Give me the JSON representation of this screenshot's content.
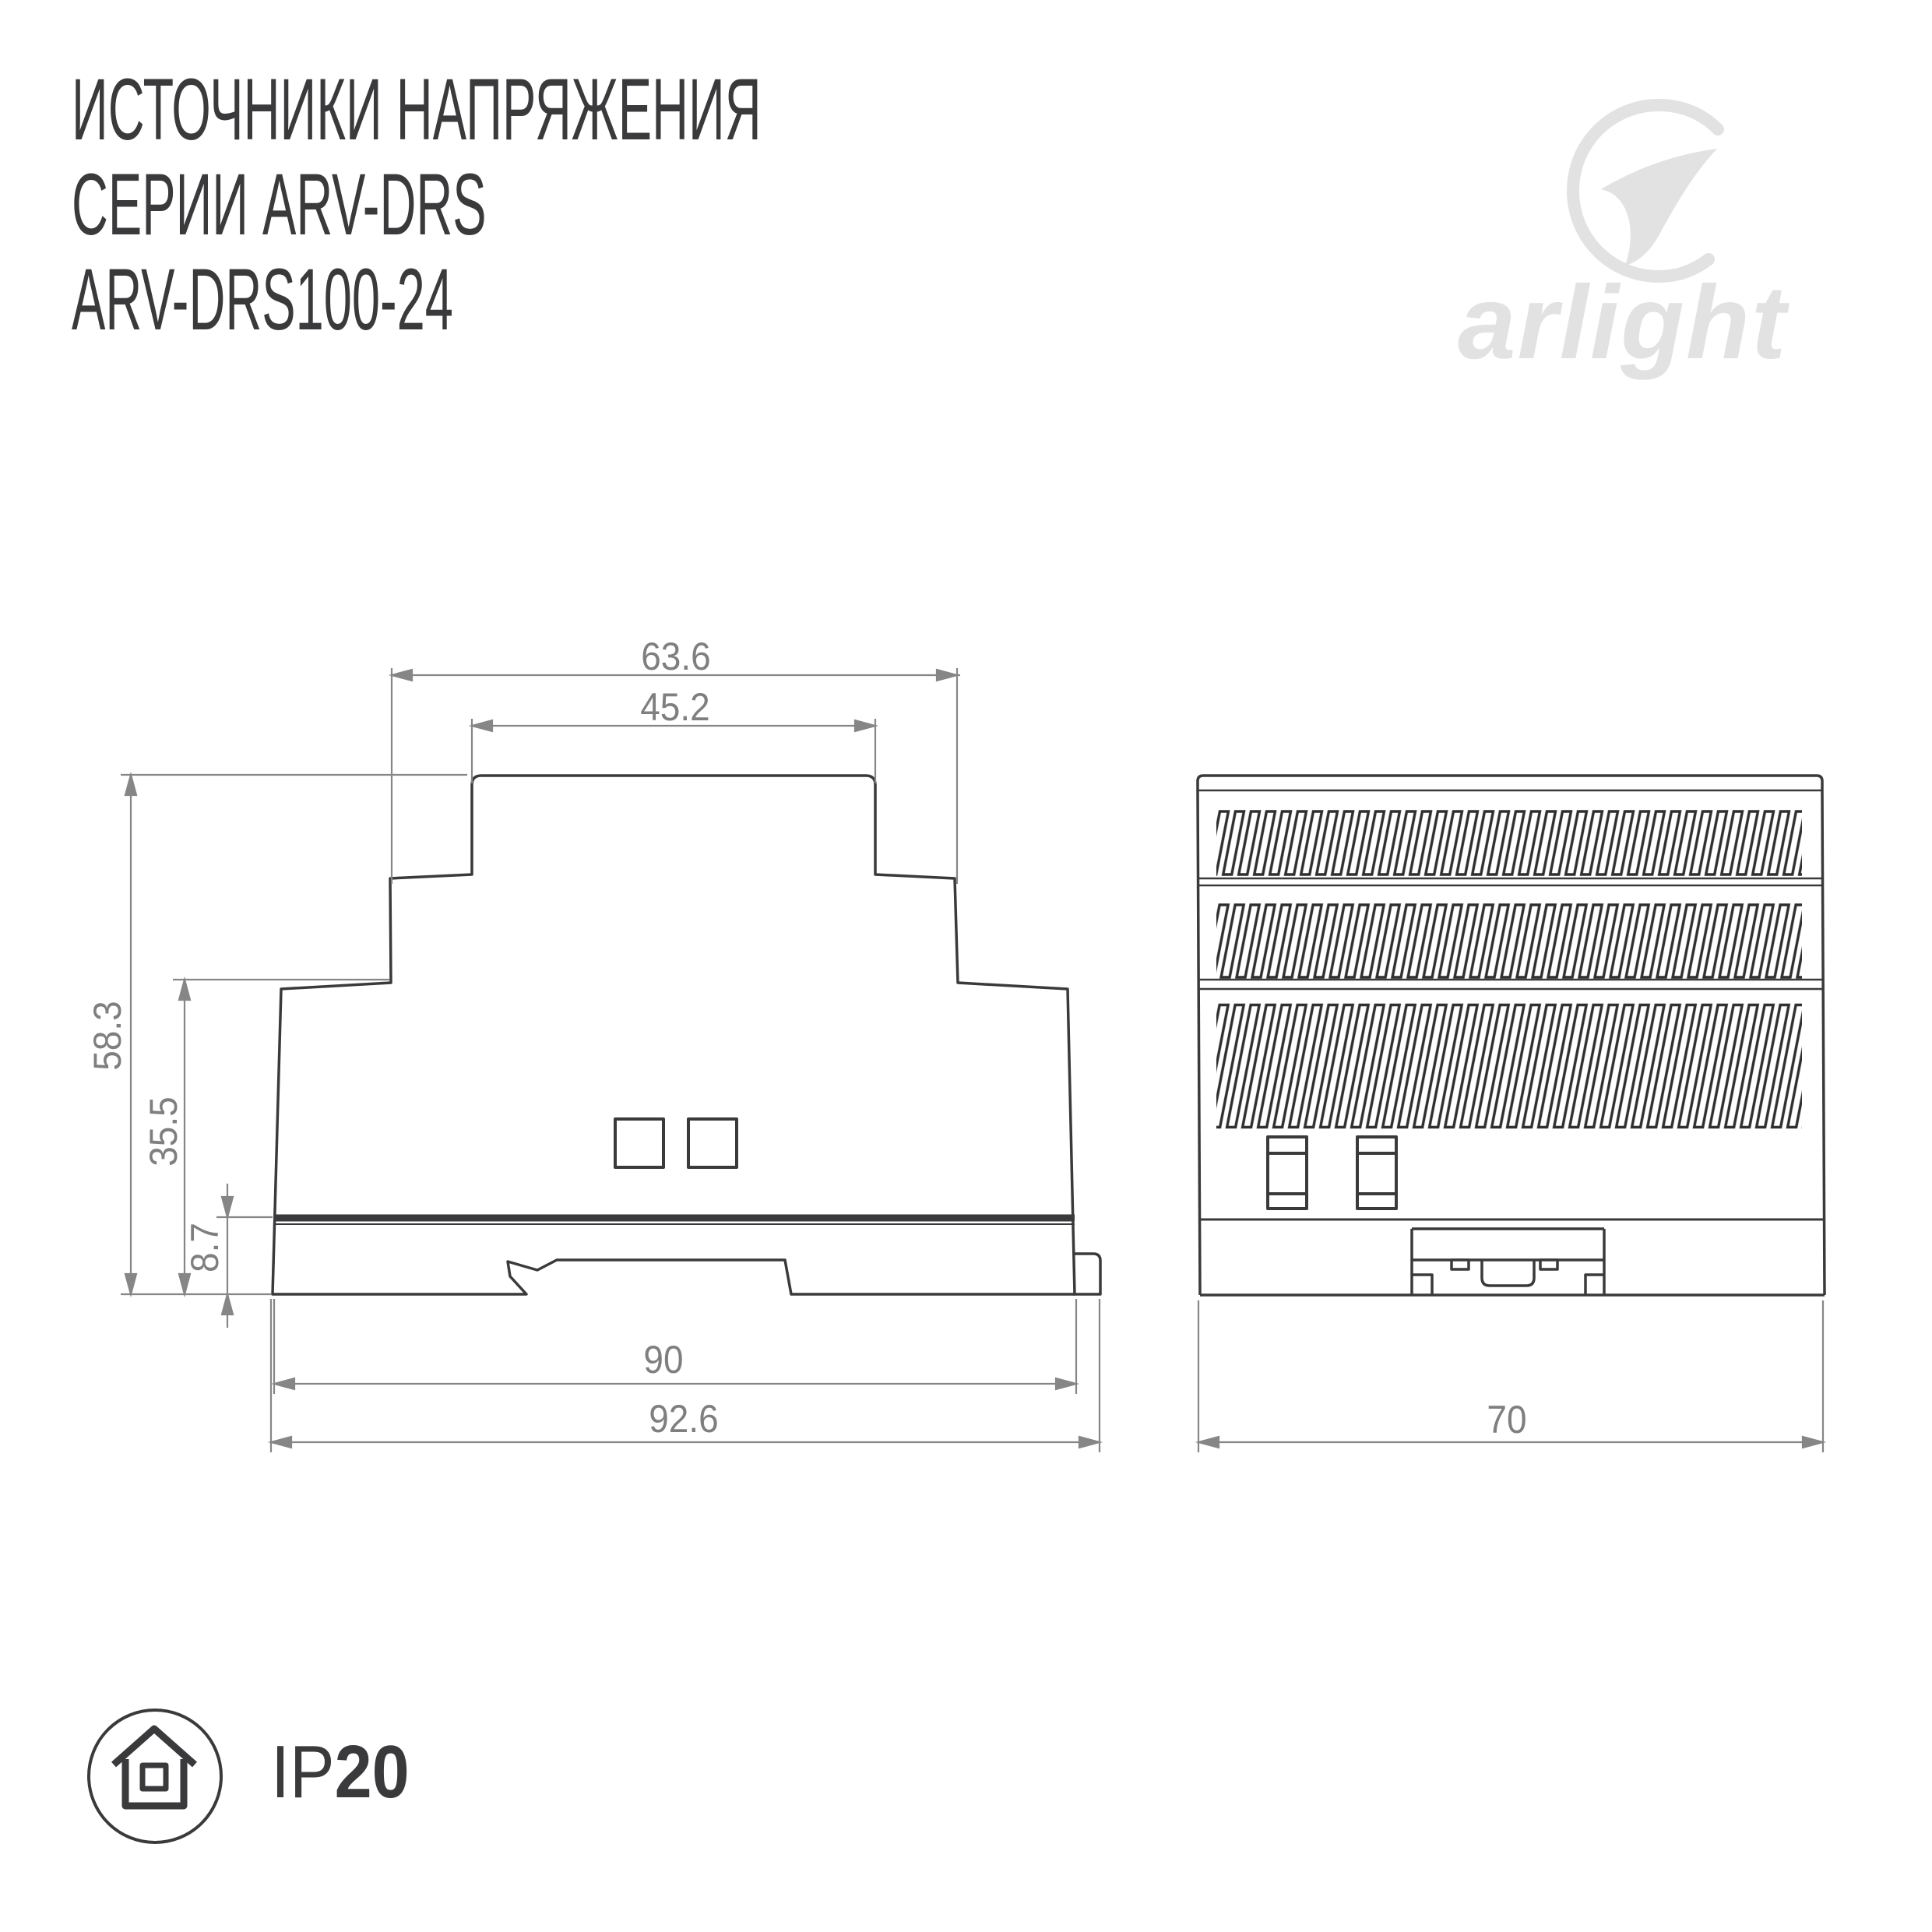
{
  "title": {
    "line1": "ИСТОЧНИКИ НАПРЯЖЕНИЯ",
    "line2": "СЕРИИ ARV-DRS",
    "line3": "ARV-DRS100-24"
  },
  "brand": {
    "wordmark": "arlight"
  },
  "side_view": {
    "dim_top_outer": "63.6",
    "dim_top_inner": "45.2",
    "dim_height_total": "58.3",
    "dim_height_body": "35.5",
    "dim_height_base": "8.7",
    "dim_width_body": "90",
    "dim_width_total": "92.6"
  },
  "front_view": {
    "dim_width": "70"
  },
  "ip_rating": {
    "prefix": "IP",
    "value": "20"
  },
  "colors": {
    "ink": "#3a3a3c",
    "dim_gray": "#868686",
    "logo_gray": "#e2e2e2"
  }
}
